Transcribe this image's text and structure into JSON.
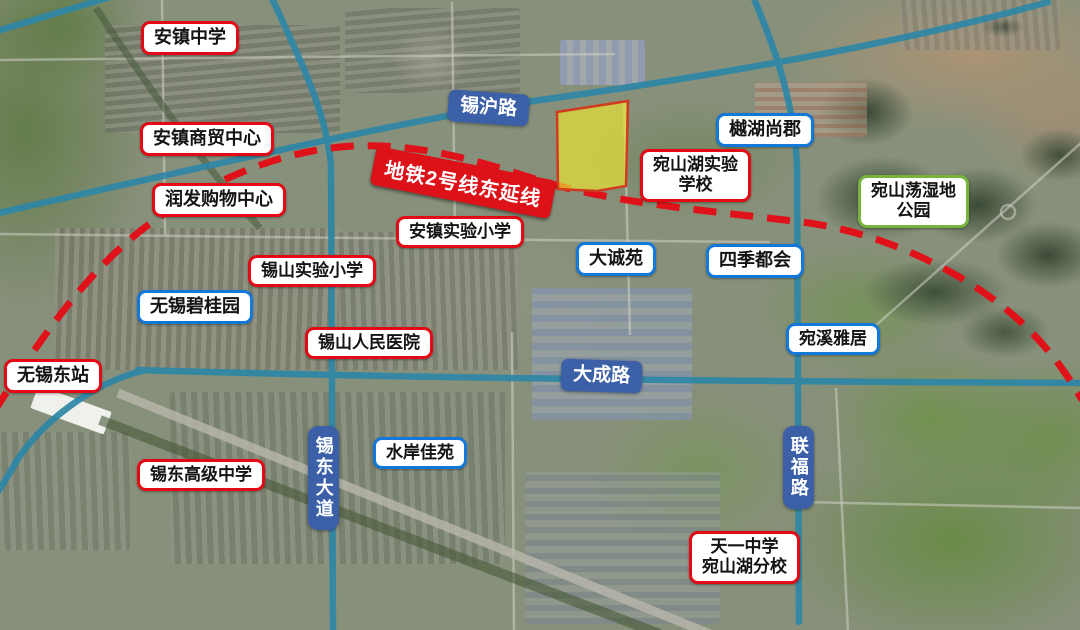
{
  "map": {
    "description": "satellite-annotation-map",
    "colors": {
      "road_highlight": "#2e87a6",
      "metro_line": "#e01219",
      "parcel_fill": "#eae432",
      "parcel_stroke": "#d03a20",
      "poi_border_red": "#e30915",
      "poi_border_blue": "#1478d8",
      "poi_border_green": "#76b43c",
      "road_label_bg": "#3c60a8",
      "metro_label_bg": "#dc1218"
    },
    "labels": {
      "anzhen_middle_school": "安镇中学",
      "anzhen_trade_center": "安镇商贸中心",
      "runfa_shopping_center": "润发购物中心",
      "xihu_road": "锡沪路",
      "metro_line2_east_extension": "地铁2号线东延线",
      "yuehu_shangjun": "樾湖尚郡",
      "wanshanhu_experimental_school": "宛山湖实验\n学校",
      "wanshandang_wetland_park": "宛山荡湿地\n公园",
      "anzhen_experimental_primary": "安镇实验小学",
      "dachengyuan": "大诚苑",
      "siji_duhui": "四季都会",
      "xishan_experimental_primary": "锡山实验小学",
      "wuxi_biguiyuan": "无锡碧桂园",
      "xishan_peoples_hospital": "锡山人民医院",
      "wanxi_yaju": "宛溪雅居",
      "wuxi_east_station": "无锡东站",
      "dacheng_road": "大成路",
      "xidong_avenue": "锡东大道",
      "shuian_jiayuan": "水岸佳苑",
      "lianfu_road": "联福路",
      "xidong_high_school": "锡东高级中学",
      "tianyi_branch_school": "天一中学\n宛山湖分校"
    }
  }
}
